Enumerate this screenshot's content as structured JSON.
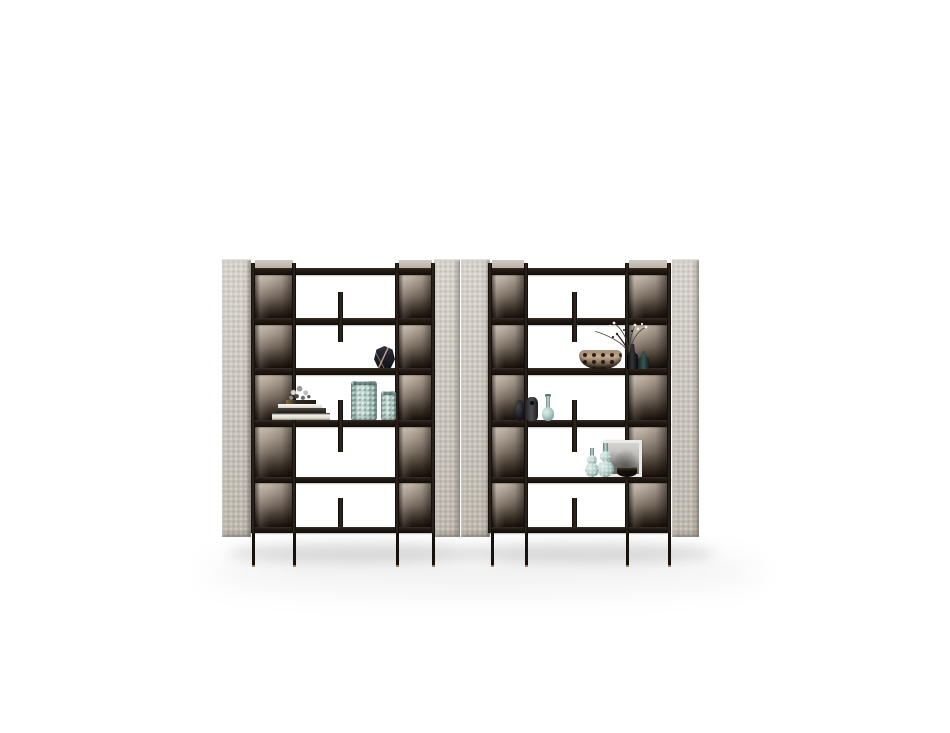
{
  "scene": {
    "label": "Studio product photo of two matching open bookshelf display units on a white background"
  },
  "colors": {
    "background": "#ffffff",
    "panel_base": "#ccc7bf",
    "panel_light": "#d8d4cd",
    "panel_dark": "#aaa49a",
    "frame_black": "#1a1410",
    "shelf_brown": "#241c15",
    "bronze_light": "#c3b6a7",
    "bronze_mid": "#7c6f63",
    "bronze_dark": "#17100a",
    "leg_brass": "#97805c",
    "teal_glass": "#adcbc6",
    "teal_deep": "#6e8d88",
    "gold_edge": "#c3a188",
    "vase_navy": "#20222c",
    "book_white": "#f1efea",
    "book_black": "#211b16",
    "leopard_tan": "#c7b094",
    "leopard_spot": "#2a1f16",
    "bottle_teal_dark": "#3a5654",
    "charcoal": "#4a4c4f",
    "art_light": "#d6d4d1",
    "art_dark": "#6f6d6b"
  },
  "units": [
    {
      "label": "Left bookshelf unit",
      "shelves": 6,
      "openings": 5,
      "items": [
        {
          "name": "faceted-vase",
          "label": "Faceted navy vase with brass edges"
        },
        {
          "name": "ornament",
          "label": "Silver decorative sprig"
        },
        {
          "name": "book-stack",
          "label": "Stack of coffee-table books"
        },
        {
          "name": "hobnail-vase-large",
          "label": "Large teal hobnail vase"
        },
        {
          "name": "hobnail-vase-small",
          "label": "Small teal hobnail vase"
        }
      ]
    },
    {
      "label": "Right bookshelf unit",
      "shelves": 6,
      "openings": 5,
      "items": [
        {
          "name": "dried-flowers",
          "label": "Dried flower branches"
        },
        {
          "name": "leopard-bowl",
          "label": "Animal print decorative bowl"
        },
        {
          "name": "black-bottle",
          "label": "Black glass bottle"
        },
        {
          "name": "teal-dark-bottle",
          "label": "Dark teal glass bottle"
        },
        {
          "name": "teardrop-vase",
          "label": "Small black teardrop vase"
        },
        {
          "name": "charcoal-vase",
          "label": "Charcoal rounded vase"
        },
        {
          "name": "genie-bottle",
          "label": "Teal long-neck bottle vase"
        },
        {
          "name": "framed-art",
          "label": "Framed monochrome artwork"
        },
        {
          "name": "gourd-bottle-small",
          "label": "Small teal gourd bottle"
        },
        {
          "name": "gourd-bottle-large",
          "label": "Large teal gourd bottle"
        },
        {
          "name": "black-bowl",
          "label": "Small black bowl"
        }
      ]
    }
  ]
}
